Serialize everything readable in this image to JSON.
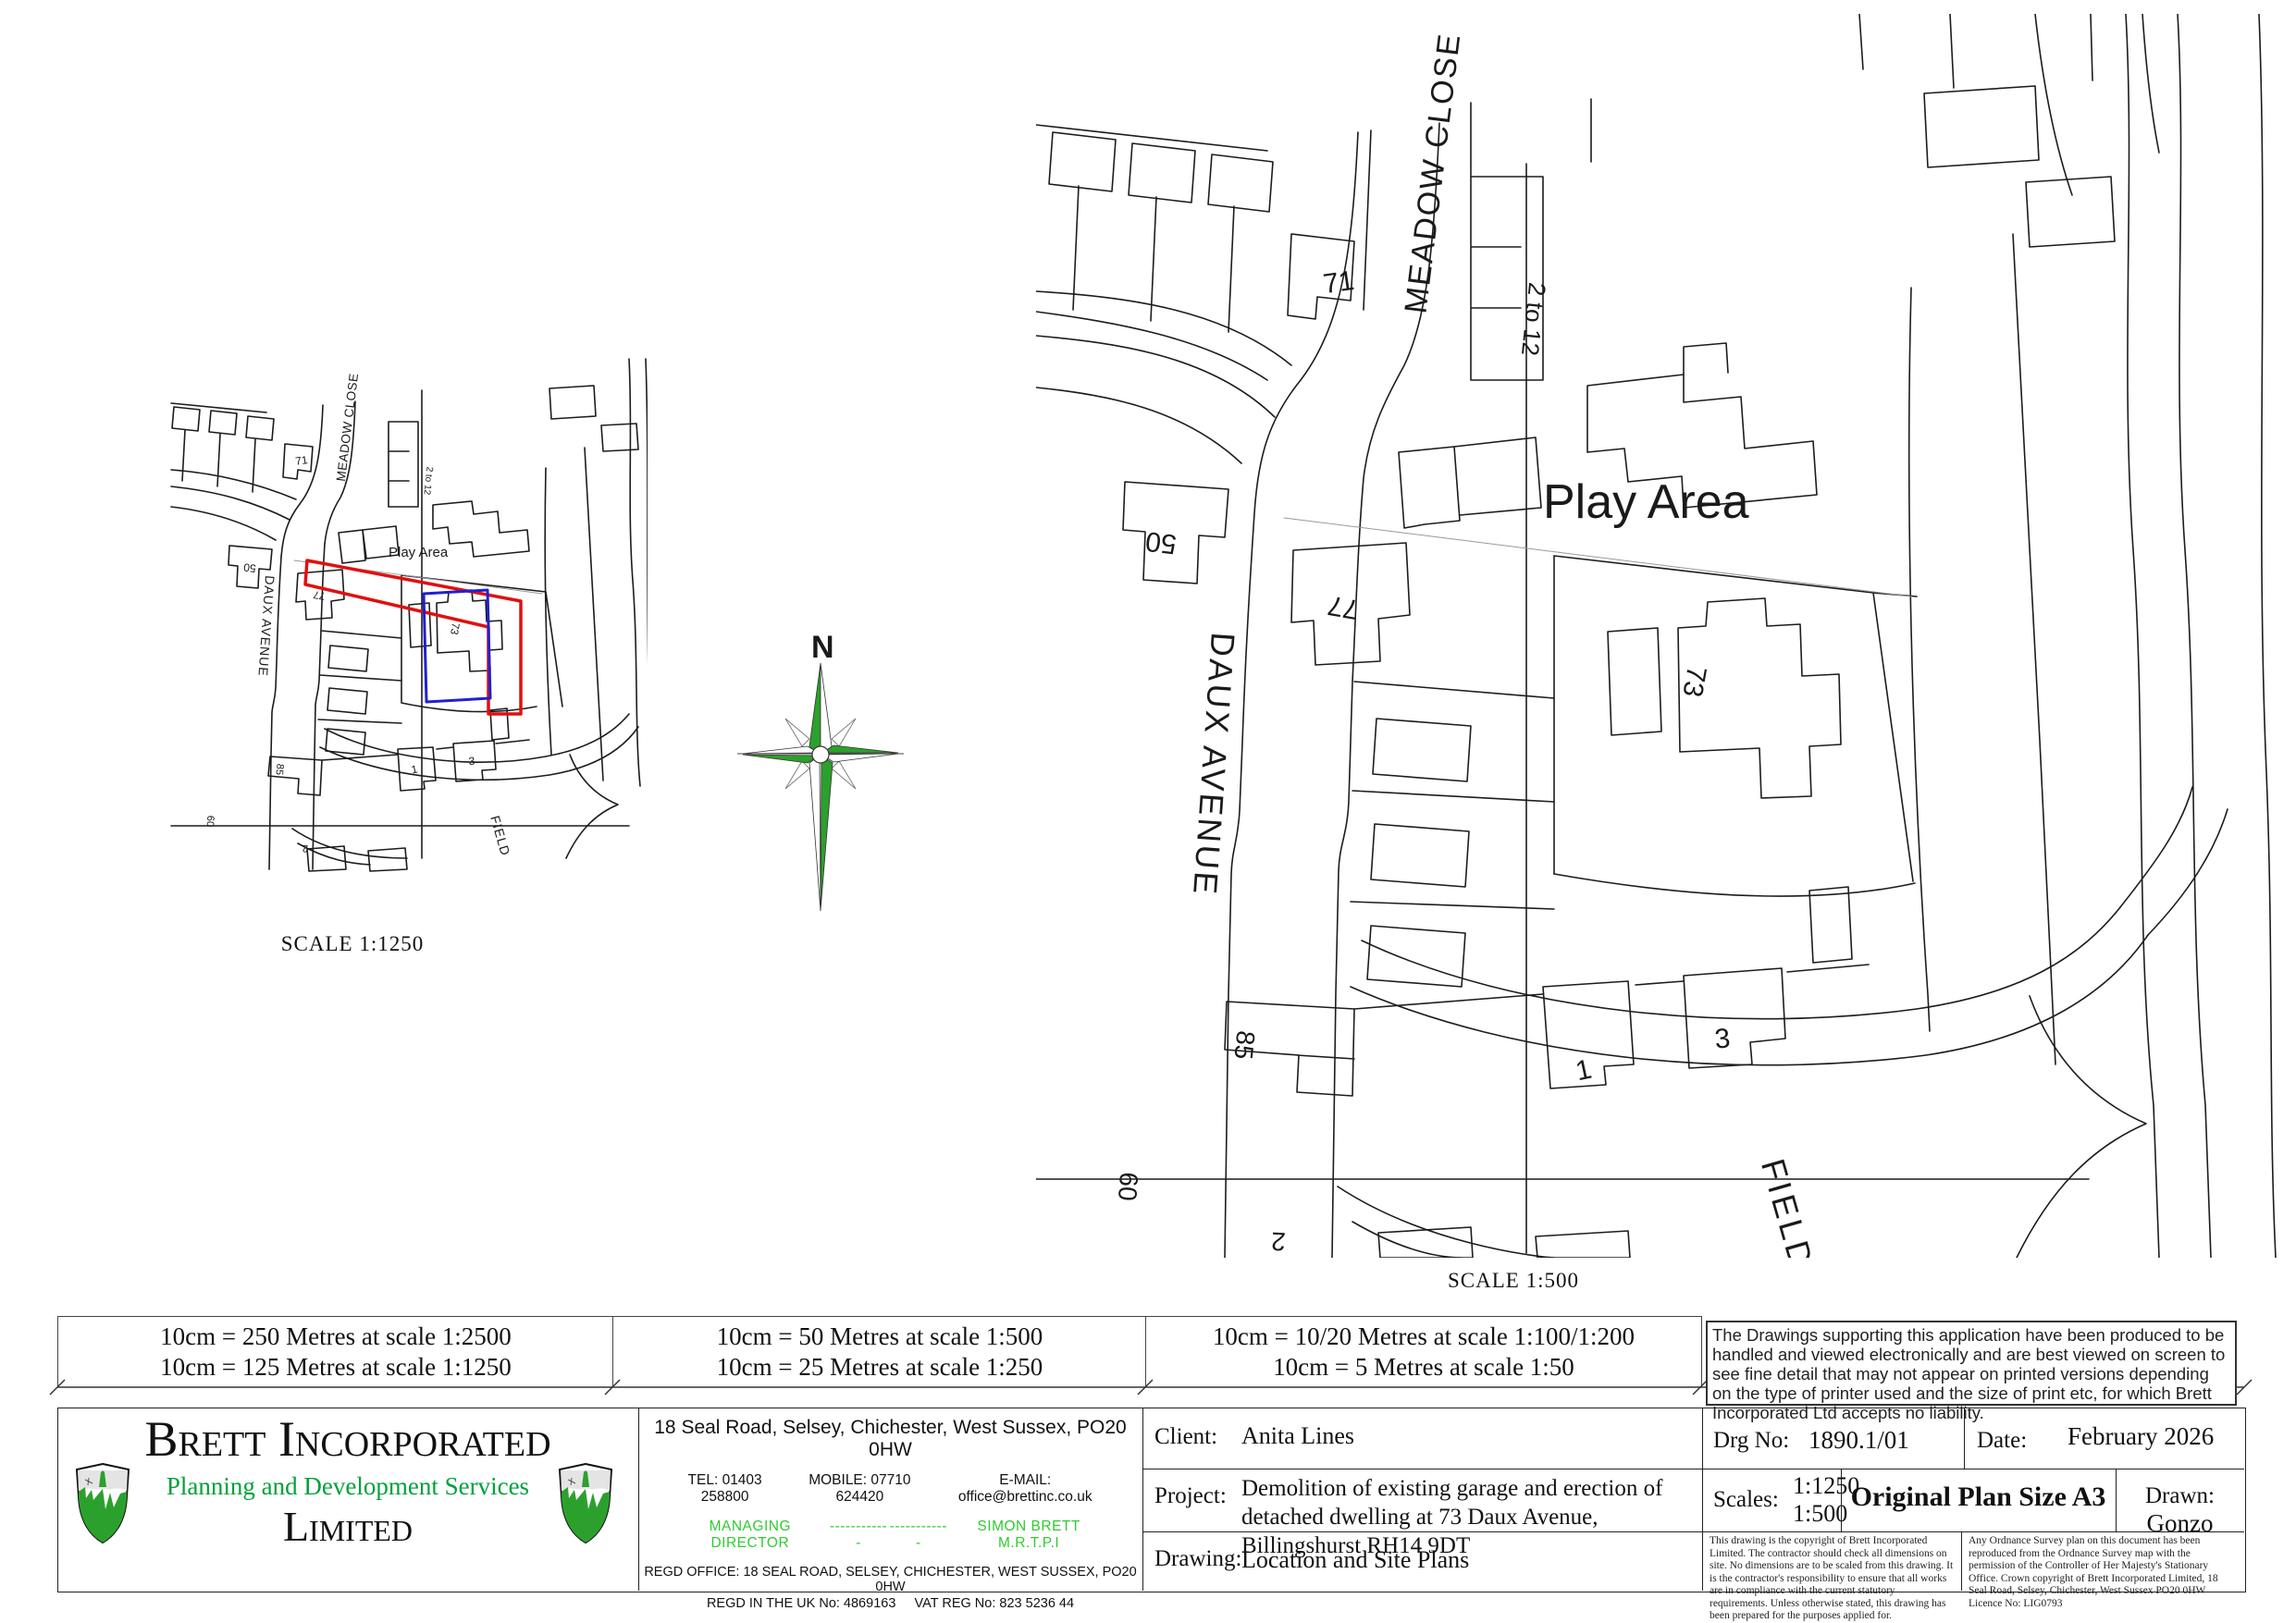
{
  "colors": {
    "site_outline_red": "#e01010",
    "proposed_building_blue": "#2020d0",
    "brand_green": "#00a13a",
    "light_green": "#2fcb2f",
    "compass_green": "#2ca02c",
    "map_line": "#1c1c1c"
  },
  "small_map": {
    "scale_label": "SCALE 1:1250"
  },
  "large_map": {
    "scale_label": "SCALE 1:500"
  },
  "map_labels": {
    "daux_avenue": "DAUX AVENUE",
    "meadow_close": "MEADOW CLOSE",
    "terrace_2_to_12": "2 to 12",
    "play_area": "Play Area",
    "field": "FIELD",
    "house_71": "71",
    "house_50": "50",
    "house_77": "77",
    "house_73": "73",
    "house_85": "85",
    "house_1": "1",
    "house_3": "3",
    "house_60": "60",
    "house_2": "2"
  },
  "compass": {
    "north_label": "N"
  },
  "scale_bar": {
    "cell1_line1": "10cm = 250 Metres at scale 1:2500",
    "cell1_line2": "10cm = 125 Metres at scale 1:1250",
    "cell2_line1": "10cm = 50 Metres at scale 1:500",
    "cell2_line2": "10cm = 25 Metres at scale 1:250",
    "cell3_line1": "10cm = 10/20 Metres at scale 1:100/1:200",
    "cell3_line2": "10cm = 5 Metres at scale 1:50",
    "disclaimer": "The Drawings supporting this application have been produced to be handled and viewed electronically and are best viewed on screen to see fine detail that may not appear on printed versions depending on the type of printer used and the size of print etc, for which Brett Incorporated Ltd accepts no liability."
  },
  "title_block": {
    "company": {
      "name": "Brett Incorporated",
      "tagline": "Planning and Development Services",
      "suffix": "Limited",
      "address": "18 Seal Road, Selsey, Chichester, West Sussex, PO20 0HW",
      "tel": "TEL: 01403 258800",
      "mobile": "MOBILE: 07710 624420",
      "email": "E-MAIL: office@brettinc.co.uk",
      "md_label": "MANAGING DIRECTOR",
      "md_dashes_1": "------------",
      "md_dashes_2": "------------",
      "md_name": "SIMON BRETT M.R.T.P.I",
      "regd_office": "REGD OFFICE: 18 SEAL ROAD, SELSEY, CHICHESTER, WEST SUSSEX, PO20 0HW",
      "regd_no": "REGD IN THE UK No: 4869163",
      "vat_no": "VAT REG No: 823 5236 44",
      "website": "www.brettinc.co.uk"
    },
    "client_label": "Client:",
    "client": "Anita Lines",
    "project_label": "Project:",
    "project": "Demolition of existing garage and erection of detached dwelling at 73 Daux Avenue, Billingshurst RH14 9DT",
    "drawing_label": "Drawing:",
    "drawing": "Location and Site Plans",
    "drg_no_label": "Drg No:",
    "drg_no": "1890.1/01",
    "date_label": "Date:",
    "date": "February 2026",
    "scales_label": "Scales:",
    "scale_1": "1:1250",
    "scale_2": "1:500",
    "plan_size": "Original Plan Size A3",
    "drawn_label": "Drawn:",
    "drawn_by": "Gonzo",
    "copyright_note": "This drawing is the copyright of Brett Incorporated Limited. The contractor should check all dimensions on site. No dimensions are to be scaled from this drawing. It is the contractor's responsibility to ensure that all works are in compliance with the current statutory requirements. Unless otherwise stated, this drawing has been prepared for the purposes applied for.",
    "os_note": "Any Ordnance Survey plan on this document has been reproduced from the Ordnance Survey map with the permission of  the Controller of Her Majesty's Stationary Office.    Crown copyright of Brett Incorporated Limited,  18 Seal Road, Selsey, Chichester, West Sussex PO20 0HW   Licence No: LIG0793"
  }
}
